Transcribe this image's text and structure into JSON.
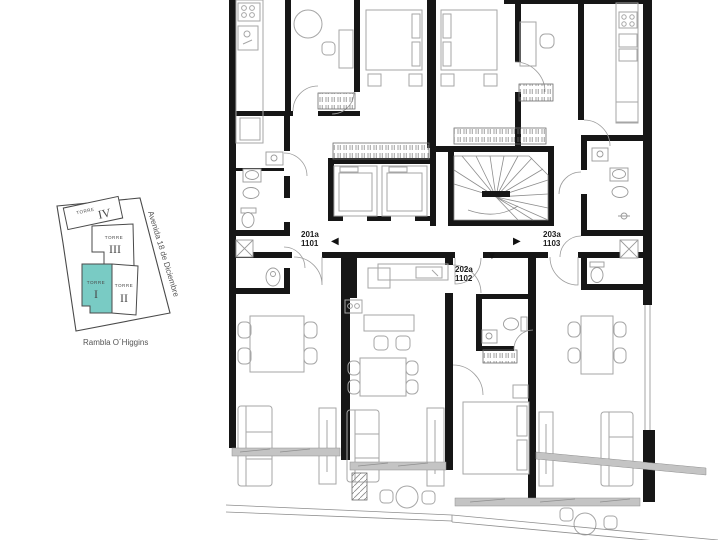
{
  "inset_map": {
    "towers": [
      {
        "label": "TORRE",
        "numeral": "IV",
        "highlighted": false
      },
      {
        "label": "TORRE",
        "numeral": "III",
        "highlighted": false
      },
      {
        "label": "TORRE",
        "numeral": "I",
        "highlighted": true
      },
      {
        "label": "TORRE",
        "numeral": "II",
        "highlighted": false
      }
    ],
    "streets": [
      {
        "name": "Avenida 18 de Diciembre"
      },
      {
        "name": "Rambla O´Higgins"
      }
    ],
    "highlight_color": "#79cbc4"
  },
  "floor_plan": {
    "units": [
      {
        "code": "201a",
        "number": "1101",
        "arrow": "◀",
        "arrow_direction": "left"
      },
      {
        "code": "203a",
        "number": "1103",
        "arrow": "▶",
        "arrow_direction": "right"
      },
      {
        "code": "202a",
        "number": "1102",
        "arrow": "▼",
        "arrow_direction": "down"
      }
    ]
  },
  "colors": {
    "wall": "#161616",
    "furniture": "#a6a6a6",
    "glass": "#c4c4c4",
    "highlight": "#79cbc4",
    "text": "#4a4a4a"
  }
}
